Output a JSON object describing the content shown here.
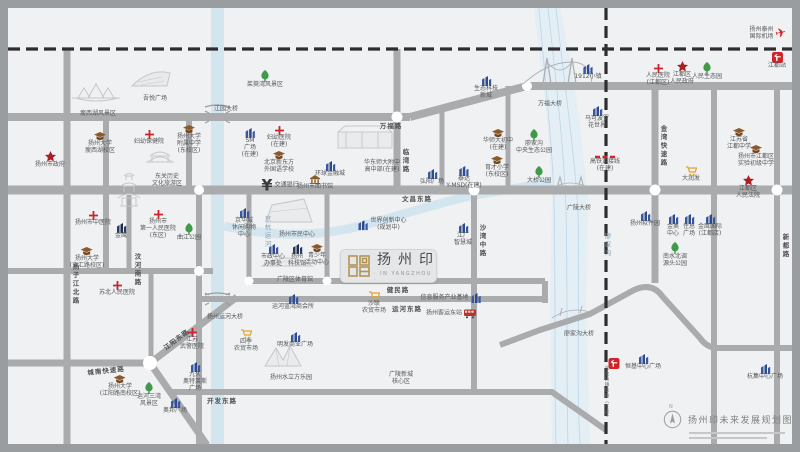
{
  "project": {
    "name": "扬州印",
    "subtitle": "· IN YANGZHOU ·"
  },
  "legend": {
    "north": "N",
    "title": "扬州印未来发展规划图"
  },
  "colors": {
    "road": "#a9abad",
    "water": "#d3e6f0",
    "railway": "#2d2e30",
    "hospital": "#c8252c",
    "government": "#aa1f24",
    "park": "#3f9b47",
    "school": "#8a5a2b",
    "commercial": "#2c4a8f",
    "market": "#e2a233",
    "brand_gold": "#b39457"
  },
  "map": {
    "road_labels": [
      {
        "text": "万福路",
        "x": 383,
        "y": 117,
        "o": "h"
      },
      {
        "text": "文昌东路",
        "x": 409,
        "y": 190,
        "o": "h"
      },
      {
        "text": "健民路",
        "x": 390,
        "y": 281,
        "o": "h"
      },
      {
        "text": "运河东路",
        "x": 399,
        "y": 300,
        "o": "h"
      },
      {
        "text": "开发东路",
        "x": 214,
        "y": 392,
        "o": "h"
      },
      {
        "text": "城南快速路",
        "x": 98,
        "y": 362,
        "o": "h",
        "r": -6
      },
      {
        "text": "江阳东路",
        "x": 168,
        "y": 331,
        "o": "h",
        "r": -37
      },
      {
        "text": "扬子江北路",
        "x": 67,
        "y": 276,
        "o": "v"
      },
      {
        "text": "汶河南路",
        "x": 129,
        "y": 262,
        "o": "v"
      },
      {
        "text": "临湾路",
        "x": 397,
        "y": 153,
        "o": "v"
      },
      {
        "text": "沙湾中路",
        "x": 474,
        "y": 233,
        "o": "v"
      },
      {
        "text": "金湾快速路",
        "x": 655,
        "y": 138,
        "o": "v"
      },
      {
        "text": "新都路",
        "x": 777,
        "y": 238,
        "o": "v"
      }
    ],
    "water_labels": [
      {
        "text": "京杭运河",
        "x": 259,
        "y": 224,
        "o": "v"
      },
      {
        "text": "廖家沟",
        "x": 599,
        "y": 237,
        "o": "v"
      }
    ],
    "railway_labels": [
      {
        "text": "连淮扬镇铁路（在建）",
        "x": 598,
        "y": 385,
        "o": "v"
      }
    ],
    "bridge_labels": [
      {
        "text": "江园大桥",
        "x": 218,
        "y": 100
      },
      {
        "text": "万福大桥",
        "x": 542,
        "y": 95
      },
      {
        "text": "广陵大桥",
        "x": 571,
        "y": 199
      },
      {
        "text": "扬州运河大桥",
        "x": 217,
        "y": 308
      },
      {
        "text": "廖家沟大桥",
        "x": 571,
        "y": 325
      }
    ],
    "pois": [
      {
        "t": "hospital",
        "x": 141,
        "y": 122,
        "l": [
          "妇幼保健院"
        ]
      },
      {
        "t": "hospital",
        "x": 271,
        "y": 118,
        "l": [
          "妇幼医院",
          "(在建)"
        ]
      },
      {
        "t": "hospital",
        "x": 85,
        "y": 203,
        "l": [
          "扬州市中医院"
        ]
      },
      {
        "t": "hospital",
        "x": 150,
        "y": 202,
        "l": [
          "扬州市",
          "第一人民医院",
          "(东区)"
        ]
      },
      {
        "t": "hospital",
        "x": 109,
        "y": 273,
        "l": [
          "苏北人民医院"
        ]
      },
      {
        "t": "hospital",
        "x": 184,
        "y": 320,
        "l": [
          "江苏",
          "武警医院"
        ]
      },
      {
        "t": "hospital",
        "x": 650,
        "y": 56,
        "l": [
          "人民医院",
          "(江都区)"
        ]
      },
      {
        "t": "school",
        "x": 92,
        "y": 124,
        "l": [
          "扬州大学",
          "瘦西湖校区"
        ]
      },
      {
        "t": "school",
        "x": 181,
        "y": 117,
        "l": [
          "扬州大学",
          "附属中学",
          "(东校区)"
        ]
      },
      {
        "t": "school",
        "x": 79,
        "y": 239,
        "l": [
          "扬州大学",
          "(文汇路校区)"
        ]
      },
      {
        "t": "school",
        "x": 112,
        "y": 367,
        "l": [
          "扬州大学",
          "(江阳路南校区)"
        ]
      },
      {
        "t": "school",
        "x": 271,
        "y": 143,
        "l": [
          "北京新东方",
          "外国语学校"
        ]
      },
      {
        "t": "school",
        "x": 490,
        "y": 121,
        "l": [
          "华师大初中",
          "(在建)"
        ]
      },
      {
        "t": "school",
        "x": 489,
        "y": 148,
        "l": [
          "育才小学",
          "(东校区)"
        ]
      },
      {
        "t": "school",
        "x": 731,
        "y": 120,
        "l": [
          "江苏省",
          "江都中学"
        ]
      },
      {
        "t": "school",
        "x": 748,
        "y": 137,
        "l": [
          "扬州市江都区",
          "实验初级中学"
        ]
      },
      {
        "t": "school",
        "x": 309,
        "y": 236,
        "l": [
          "青少年",
          "活动中心"
        ]
      },
      {
        "t": "library",
        "x": 307,
        "y": 167,
        "l": [
          "扬州市图书馆"
        ]
      },
      {
        "t": "gov",
        "x": 42,
        "y": 143,
        "l": [
          "扬州市政府"
        ]
      },
      {
        "t": "gov",
        "x": 674,
        "y": 53,
        "l": [
          "江都区",
          "人民政府"
        ]
      },
      {
        "t": "gov",
        "x": 740,
        "y": 167,
        "l": [
          "江都区",
          "人民法院"
        ]
      },
      {
        "t": "park",
        "x": 257,
        "y": 62,
        "l": [
          "茱萸湾风景区"
        ]
      },
      {
        "t": "park",
        "x": 181,
        "y": 215,
        "l": [
          "曲江公园"
        ]
      },
      {
        "t": "park",
        "x": 526,
        "y": 121,
        "l": [
          "廖家沟",
          "中央生态公园"
        ]
      },
      {
        "t": "park",
        "x": 531,
        "y": 158,
        "l": [
          "大桥公园"
        ]
      },
      {
        "t": "park",
        "x": 141,
        "y": 374,
        "l": [
          "运河三湾",
          "风景区"
        ]
      },
      {
        "t": "park",
        "x": 699,
        "y": 54,
        "l": [
          "人民生态园"
        ]
      },
      {
        "t": "park",
        "x": 667,
        "y": 234,
        "l": [
          "南水北调",
          "源头公园"
        ]
      },
      {
        "t": "mall",
        "x": 242,
        "y": 120,
        "l": [
          "SM",
          "广场",
          "(在建)"
        ]
      },
      {
        "t": "mall",
        "x": 322,
        "y": 153,
        "l": [
          "环球金融城"
        ]
      },
      {
        "t": "malldark",
        "x": 113,
        "y": 215,
        "l": [
          "金鹰"
        ]
      },
      {
        "t": "mall",
        "x": 236,
        "y": 200,
        "l": [
          "京华城",
          "休闲购物",
          "中心"
        ]
      },
      {
        "t": "mall",
        "x": 374,
        "y": 217,
        "l": [
          "世界创新中心",
          "(规划中)"
        ],
        "p": "left"
      },
      {
        "t": "mall",
        "x": 455,
        "y": 215,
        "l": [
          "江广",
          "智慧城"
        ]
      },
      {
        "t": "mall",
        "x": 424,
        "y": 161,
        "l": [
          "弘阳广场"
        ]
      },
      {
        "t": "mall",
        "x": 456,
        "y": 158,
        "l": [
          "泰达",
          "Y-MSD(在建)"
        ]
      },
      {
        "t": "mall",
        "x": 478,
        "y": 68,
        "l": [
          "生态科技",
          "新城"
        ]
      },
      {
        "t": "mall",
        "x": 580,
        "y": 56,
        "l": [
          "1912小镇"
        ]
      },
      {
        "t": "mall",
        "x": 589,
        "y": 98,
        "l": [
          "马可波罗",
          "花世界"
        ]
      },
      {
        "t": "mall",
        "x": 637,
        "y": 203,
        "l": [
          "扬州软件园"
        ]
      },
      {
        "t": "mall",
        "x": 665,
        "y": 206,
        "l": [
          "金奥",
          "中心"
        ]
      },
      {
        "t": "mall",
        "x": 681,
        "y": 206,
        "l": [
          "住总",
          "广场"
        ]
      },
      {
        "t": "mall",
        "x": 702,
        "y": 206,
        "l": [
          "金鹰国际",
          "(江都店)"
        ]
      },
      {
        "t": "mall",
        "x": 635,
        "y": 346,
        "l": [
          "恒基中心广场"
        ]
      },
      {
        "t": "mall",
        "x": 187,
        "y": 354,
        "l": [
          "九久",
          "奥特莱斯",
          "广场"
        ]
      },
      {
        "t": "mall",
        "x": 167,
        "y": 390,
        "l": [
          "奥邦广场"
        ]
      },
      {
        "t": "mall",
        "x": 287,
        "y": 324,
        "l": [
          "明发商业广场"
        ]
      },
      {
        "t": "mall",
        "x": 285,
        "y": 286,
        "l": [
          "运河蓝湾商会所"
        ]
      },
      {
        "t": "mall",
        "x": 443,
        "y": 290,
        "l": [
          "信息服务产业基地"
        ],
        "p": "right"
      },
      {
        "t": "mall",
        "x": 757,
        "y": 356,
        "l": [
          "杭集中心广场"
        ]
      },
      {
        "t": "bus",
        "x": 443,
        "y": 306,
        "l": [
          "扬州客运东站"
        ],
        "p": "right"
      },
      {
        "t": "cart",
        "x": 683,
        "y": 158,
        "l": [
          "大润发"
        ]
      },
      {
        "t": "cart",
        "x": 366,
        "y": 283,
        "l": [
          "沙联",
          "农贸市场"
        ]
      },
      {
        "t": "cart",
        "x": 238,
        "y": 321,
        "l": [
          "四季",
          "农贸市场"
        ]
      },
      {
        "t": "bank",
        "x": 272,
        "y": 178,
        "l": [
          "交通银行"
        ],
        "p": "left"
      },
      {
        "t": "plane",
        "x": 760,
        "y": 26,
        "l": [
          "扬州泰州",
          "国际机场"
        ],
        "p": "right"
      },
      {
        "t": "raillogo",
        "x": 769,
        "y": 44,
        "l": [
          "江都站"
        ]
      },
      {
        "t": "raillogo",
        "x": 606,
        "y": 350,
        "l": []
      },
      {
        "t": "redline",
        "x": 597,
        "y": 147,
        "l": [
          "高铁连接线",
          "(在建)"
        ]
      },
      {
        "t": "label",
        "x": 374,
        "y": 152,
        "l": [
          "华东师大附中",
          "高中部(在建)"
        ]
      },
      {
        "t": "label",
        "x": 90,
        "y": 103,
        "l": [
          "瘦西湖风景区"
        ]
      },
      {
        "t": "label",
        "x": 147,
        "y": 88,
        "l": [
          "吾悦广场"
        ]
      },
      {
        "t": "label",
        "x": 159,
        "y": 166,
        "l": [
          "东关历史",
          "文化旅游区"
        ]
      },
      {
        "t": "label",
        "x": 289,
        "y": 224,
        "l": [
          "扬州市民中心"
        ]
      },
      {
        "t": "mall",
        "x": 265,
        "y": 236,
        "l": [
          "市政中心",
          "办事处"
        ]
      },
      {
        "t": "malldark",
        "x": 289,
        "y": 236,
        "l": [
          "扬州",
          "科技馆"
        ]
      },
      {
        "t": "label",
        "x": 287,
        "y": 269,
        "l": [
          "广陵区体育馆"
        ]
      },
      {
        "t": "label",
        "x": 283,
        "y": 367,
        "l": [
          "扬州水立方乐园"
        ]
      },
      {
        "t": "label",
        "x": 393,
        "y": 364,
        "l": [
          "广陵新城",
          "核心区"
        ]
      }
    ]
  }
}
